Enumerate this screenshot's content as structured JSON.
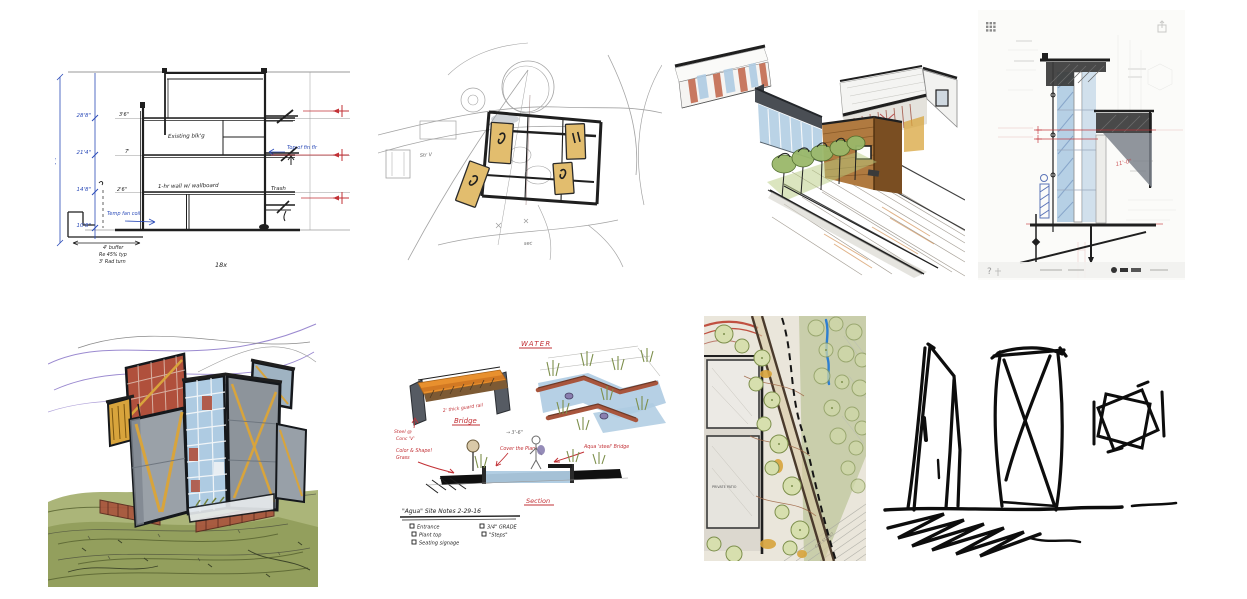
{
  "page": {
    "background": "#ffffff",
    "description": "Grid collage of eight hand-drawn architectural sketches"
  },
  "palette": {
    "paper": "#ffffff",
    "ink": "#1f1f1f",
    "pencil": "#9a9a9a",
    "bluepen": "#2b4bb8",
    "redpen": "#c23136",
    "tan": "#e2bd6e",
    "glass": "#aecbe2",
    "wood": "#b07a40",
    "tree": "#9ab86a",
    "olive": "#7d8f4c",
    "rust": "#a8553d",
    "gold": "#d8a43c",
    "purple": "#9b8ad0",
    "beige": "#eae6db",
    "hill": "#96a258",
    "concrete": "#9aa1a8"
  },
  "gallery": {
    "items": [
      {
        "id": "building-section",
        "description": "Pen building-section sketch with blue dimension string and red level targets",
        "dim_total": "74'",
        "dims_left": [
          "28'8\"",
          "21'4\"",
          "14'8\"",
          "10'8\""
        ],
        "wall_dims": [
          "3'6\"",
          "7'",
          "2'6\""
        ],
        "notes": {
          "floor": "Existing blk'g",
          "wall": "1-hr wall w/ wallboard",
          "trash": "Trash",
          "blue_right": "Top of fin flr",
          "blue_left": "Temp fan coil",
          "footer1": "4' buffer",
          "footer2": "Re 45% typ",
          "footer3": "3' Rad turn",
          "scale": "18x"
        }
      },
      {
        "id": "concept-plan",
        "description": "Loose felt-pen concept plan, four tan building bars around a court",
        "note_left": "Str V",
        "note_bottom": "sec"
      },
      {
        "id": "aerial-perspective",
        "description": "Colored aerial perspective: flat-roof pavilion, wood volume, glass walls, courtyard trees"
      },
      {
        "id": "wall-section-detail",
        "description": "Marker wall-section detail sketched over a faint CAD sheet",
        "help_glyph": "?",
        "red_note": "11'-0\""
      },
      {
        "id": "watercolor-massing",
        "description": "Watercolor massing study of stacked tower volumes on a green hill"
      },
      {
        "id": "landscape-notes",
        "description": "Landscape design notes: bridge detail, water feature, section",
        "labels": {
          "water": "WATER",
          "bridge": "Bridge",
          "section": "Section"
        },
        "bridge_note": "2' thick guard rail",
        "left_note1": "Steel @",
        "left_note2": "Conc 'V'",
        "mid_dim": "3'-6\"",
        "red_note1": "Color & Shape!",
        "red_note2": "Grass",
        "red_note3": "Cover the Plant",
        "red_note4": "Aqua 'steel' Bridge",
        "title": "\"Agua\" Site Notes  2-29-16",
        "checklist_col1": [
          "Entrance",
          "Plant top",
          "Seating signage"
        ],
        "checklist_col2": [
          "3/4\" GRADE",
          "\"Steps\""
        ]
      },
      {
        "id": "site-plan",
        "description": "Colored landscape site plan with tree rows, promenade and dashed path",
        "labels": {
          "patio": "PRIVATE PATIO",
          "street": "CITY STREET"
        }
      },
      {
        "id": "ink-massing",
        "description": "Bold marker massing sketch: two towers and rotated-square plan glyph"
      }
    ]
  }
}
